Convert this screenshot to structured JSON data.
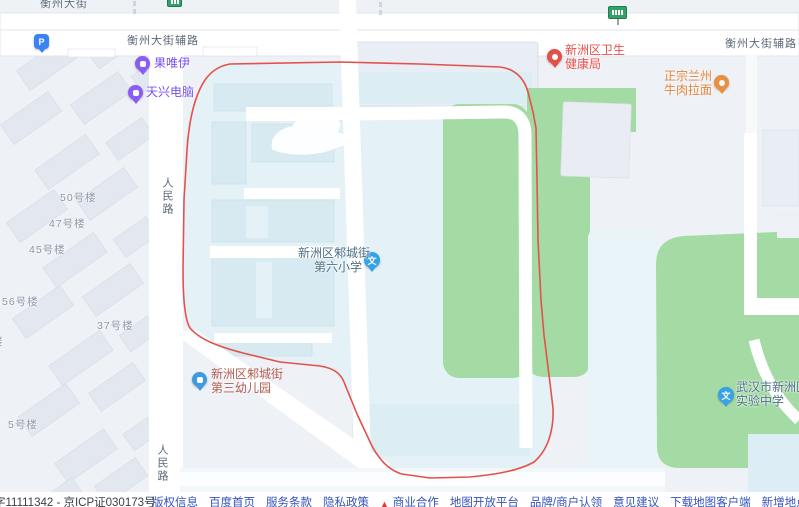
{
  "map": {
    "road_labels": {
      "hengzhou_top": "衡州大街",
      "fulu_left": "衡州大街辅路",
      "fulu_right": "衡州大街辅路",
      "renmin_upper": "人民路",
      "renmin_lower": "人民路"
    },
    "building_labels": [
      "50号楼",
      "47号楼",
      "45号楼",
      "56号楼",
      "37号楼",
      "5号楼",
      "楼"
    ],
    "pois": {
      "parking": {
        "icon_char": "P"
      },
      "fruit_shop": {
        "name": "果唯伊"
      },
      "computer_shop": {
        "name": "天兴电脑"
      },
      "health_bureau": {
        "line1": "新洲区卫生",
        "line2": "健康局"
      },
      "noodle_restaurant": {
        "line1": "正宗兰州",
        "line2": "牛肉拉面"
      },
      "primary_school": {
        "line1": "新洲区邾城街",
        "line2": "第六小学",
        "icon_char": "文"
      },
      "kindergarten": {
        "line1": "新洲区邾城街",
        "line2": "第三幼儿园"
      },
      "middle_school": {
        "line1": "武汉市新洲区",
        "line2": "实验中学",
        "icon_char": "文"
      }
    },
    "colors": {
      "selection_outline": "#e5514a",
      "green_area": "#a4dba5",
      "campus_fill": "#e4f2f7",
      "road": "#ffffff",
      "poi_purple": "#7a4ff0",
      "poi_red": "#e4504a",
      "poi_orange": "#e2823a",
      "poi_blue": "#35a2e8",
      "footer_link": "#3552bd"
    }
  },
  "footer": {
    "icp": "字11111342 - 京ICP证030173号",
    "flame_icon": "▲",
    "links": [
      "版权信息",
      "百度首页",
      "服务条款",
      "隐私政策",
      "商业合作",
      "地图开放平台",
      "品牌/商户认领",
      "意见建议",
      "下载地图客户端",
      "新增地点",
      "百度营销"
    ]
  }
}
